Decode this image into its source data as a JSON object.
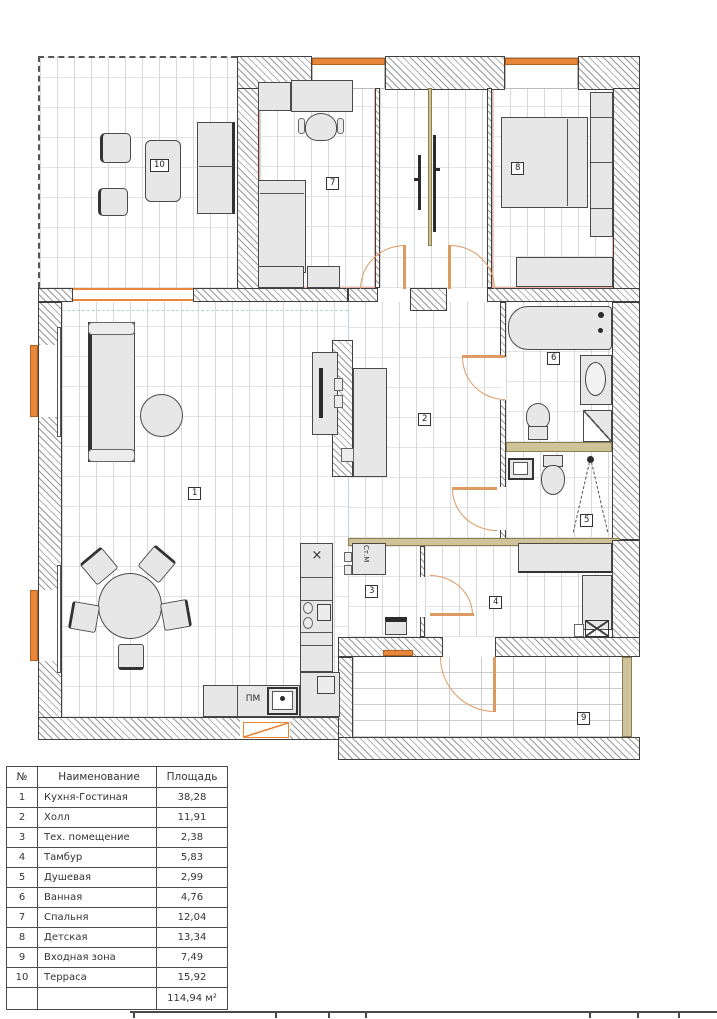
{
  "legend_table": {
    "headers": {
      "num": "№",
      "name": "Наименование",
      "area": "Площадь"
    },
    "rows": [
      {
        "num": "1",
        "name": "Кухня-Гостиная",
        "area": "38,28"
      },
      {
        "num": "2",
        "name": "Холл",
        "area": "11,91"
      },
      {
        "num": "3",
        "name": "Тех. помещение",
        "area": "2,38"
      },
      {
        "num": "4",
        "name": "Тамбур",
        "area": "5,83"
      },
      {
        "num": "5",
        "name": "Душевая",
        "area": "2,99"
      },
      {
        "num": "6",
        "name": "Ванная",
        "area": "4,76"
      },
      {
        "num": "7",
        "name": "Спальня",
        "area": "12,04"
      },
      {
        "num": "8",
        "name": "Детская",
        "area": "13,34"
      },
      {
        "num": "9",
        "name": "Входная зона",
        "area": "7,49"
      },
      {
        "num": "10",
        "name": "Терраса",
        "area": "15,92"
      }
    ],
    "total_area": "114,94 м²"
  },
  "plan": {
    "room_labels": {
      "kitchen_living": "1",
      "hall": "2",
      "tech": "3",
      "tambour": "4",
      "shower": "5",
      "bath": "6",
      "bedroom": "7",
      "kids_room": "8",
      "entry": "9",
      "terrace": "10"
    },
    "appliance_labels": {
      "dishwasher": "ПМ",
      "washing_machine": "Ст.М",
      "hob": "×"
    },
    "colors": {
      "window": "#e8873b",
      "door": "#dd9a62",
      "threshold": "#cfc39a",
      "guide": "#b5cfe2"
    }
  }
}
